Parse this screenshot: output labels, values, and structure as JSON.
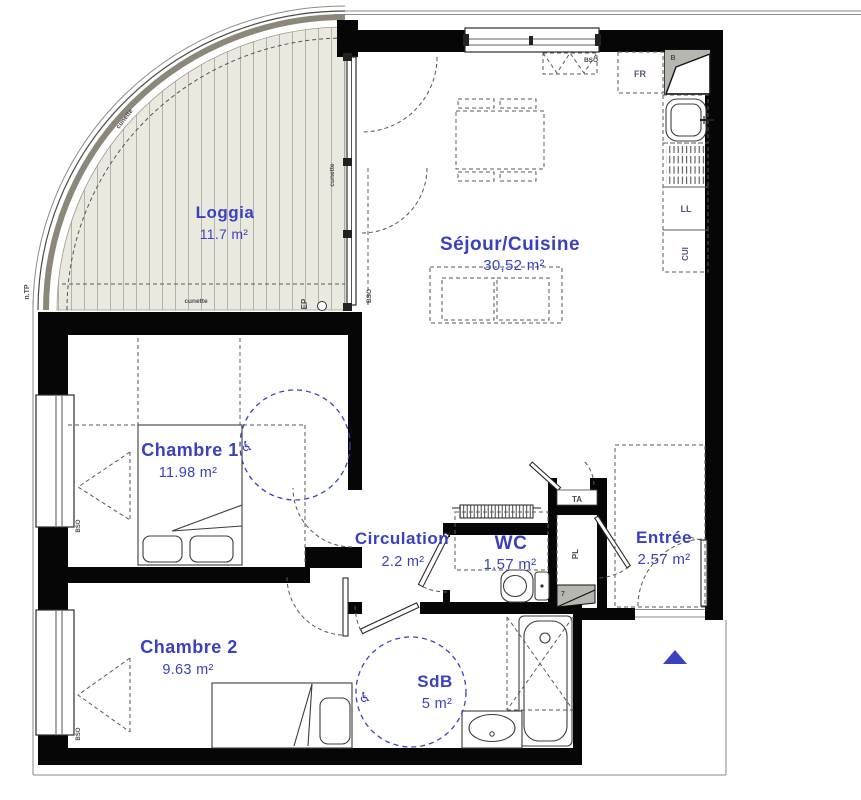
{
  "colors": {
    "accent": "#3a41c1",
    "wall": "#060606",
    "muted_label": "#4e5878",
    "dark_label": "#4a4a52",
    "loggia_fill": "#eae9e0",
    "loggia_band": "#8d8779",
    "hatch_line": "#b3b2a6",
    "furniture": "#3c3c3c",
    "dash": "#5a5a5a",
    "gray_fill": "#b7b7b2"
  },
  "rooms": {
    "loggia": {
      "name": "Loggia",
      "area": "11.7 m²"
    },
    "sejour": {
      "name": "Séjour/Cuisine",
      "area": "30,52 m²"
    },
    "chambre1": {
      "name": "Chambre 1",
      "area": "11.98 m²"
    },
    "circulation": {
      "name": "Circulation",
      "area": "2.2 m²"
    },
    "wc": {
      "name": "WC",
      "area": "1.57 m²"
    },
    "entree": {
      "name": "Entrée",
      "area": "2.57 m²"
    },
    "chambre2": {
      "name": "Chambre 2",
      "area": "9.63 m²"
    },
    "sdb": {
      "name": "SdB",
      "area": "5 m²"
    }
  },
  "annotations": {
    "fridge": "FR",
    "corner_unit": "B",
    "washing_machine": "LL",
    "kitchen_column": "CUI",
    "electrical_panel": "TA",
    "closet": "PL",
    "duct": "7",
    "blind_top": "BSO",
    "blind_sejour": "BSO",
    "blind_chambre1": "BSO",
    "blind_chambre2": "BSO",
    "gutter_top": "cunette",
    "gutter_right": "cunette",
    "gutter_bottom": "cunette",
    "rain_pipe": "EP",
    "technical_label": "n.TP"
  },
  "icons": {
    "wheelchair": "♿"
  }
}
